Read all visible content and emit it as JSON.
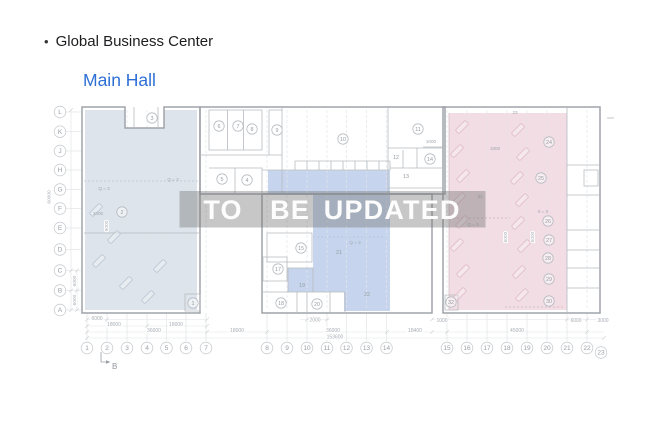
{
  "header": {
    "bullet": "•",
    "title": "Global Business Center",
    "subtitle": "Main Hall"
  },
  "watermark": {
    "text": "TO  BE UPDATED"
  },
  "colors": {
    "title": "#1d1d1f",
    "subtitle": "#2e6fd6",
    "left_zone": "#dde4eb",
    "middle_zone": "#c6d5ed",
    "right_zone": "#f1dde3",
    "band": "rgba(115,115,115,0.40)",
    "watermark_text": "#ffffff"
  },
  "axes": {
    "rows": [
      {
        "label": "L",
        "y": 112
      },
      {
        "label": "K",
        "y": 131.7
      },
      {
        "label": "J",
        "y": 151
      },
      {
        "label": "H",
        "y": 170
      },
      {
        "label": "G",
        "y": 189.5
      },
      {
        "label": "F",
        "y": 208.5
      },
      {
        "label": "E",
        "y": 228
      },
      {
        "label": "D",
        "y": 249.5
      },
      {
        "label": "C",
        "y": 270.5
      },
      {
        "label": "B",
        "y": 290.5
      },
      {
        "label": "A",
        "y": 310
      }
    ],
    "cols": [
      {
        "label": "1",
        "x": 87
      },
      {
        "label": "2",
        "x": 107
      },
      {
        "label": "3",
        "x": 127
      },
      {
        "label": "4",
        "x": 147
      },
      {
        "label": "5",
        "x": 166.5
      },
      {
        "label": "6",
        "x": 186
      },
      {
        "label": "7",
        "x": 206
      },
      {
        "label": "8",
        "x": 267
      },
      {
        "label": "9",
        "x": 287
      },
      {
        "label": "10",
        "x": 307
      },
      {
        "label": "11",
        "x": 327
      },
      {
        "label": "12",
        "x": 346.5
      },
      {
        "label": "13",
        "x": 366.5
      },
      {
        "label": "14",
        "x": 386.5
      },
      {
        "label": "15",
        "x": 447
      },
      {
        "label": "16",
        "x": 467
      },
      {
        "label": "17",
        "x": 487
      },
      {
        "label": "18",
        "x": 507
      },
      {
        "label": "19",
        "x": 527
      },
      {
        "label": "20",
        "x": 547
      },
      {
        "label": "21",
        "x": 567
      },
      {
        "label": "22",
        "x": 587
      },
      {
        "label": "23",
        "x": 601,
        "dy": 4.5
      }
    ]
  },
  "rooms": [
    {
      "n": "1",
      "x": 193,
      "y": 303,
      "circled": true
    },
    {
      "n": "2",
      "x": 122,
      "y": 212,
      "circled": true
    },
    {
      "n": "3",
      "x": 152,
      "y": 118,
      "circled": true
    },
    {
      "n": "4",
      "x": 247,
      "y": 180,
      "circled": true
    },
    {
      "n": "5",
      "x": 222,
      "y": 179,
      "circled": true
    },
    {
      "n": "6",
      "x": 219,
      "y": 126,
      "circled": true
    },
    {
      "n": "7",
      "x": 238,
      "y": 126,
      "circled": true
    },
    {
      "n": "8",
      "x": 252,
      "y": 129,
      "circled": true
    },
    {
      "n": "9",
      "x": 277,
      "y": 130,
      "circled": true
    },
    {
      "n": "10",
      "x": 343,
      "y": 139,
      "circled": true
    },
    {
      "n": "11",
      "x": 418,
      "y": 129,
      "circled": true
    },
    {
      "n": "12",
      "x": 396,
      "y": 157,
      "circled": false
    },
    {
      "n": "13",
      "x": 406,
      "y": 176,
      "circled": false
    },
    {
      "n": "14",
      "x": 430,
      "y": 159,
      "circled": true
    },
    {
      "n": "15",
      "x": 301,
      "y": 248,
      "circled": true
    },
    {
      "n": "17",
      "x": 278,
      "y": 269,
      "circled": true
    },
    {
      "n": "18",
      "x": 281,
      "y": 303,
      "circled": true
    },
    {
      "n": "19",
      "x": 302,
      "y": 285,
      "circled": false
    },
    {
      "n": "20",
      "x": 317,
      "y": 304,
      "circled": true
    },
    {
      "n": "21",
      "x": 339,
      "y": 252,
      "circled": false
    },
    {
      "n": "22",
      "x": 367,
      "y": 294,
      "circled": false
    },
    {
      "n": "24",
      "x": 549,
      "y": 142,
      "circled": true
    },
    {
      "n": "25",
      "x": 541,
      "y": 178,
      "circled": true
    },
    {
      "n": "26",
      "x": 548,
      "y": 221,
      "circled": true
    },
    {
      "n": "27",
      "x": 549,
      "y": 240,
      "circled": true
    },
    {
      "n": "28",
      "x": 548,
      "y": 258,
      "circled": true
    },
    {
      "n": "29",
      "x": 549,
      "y": 279,
      "circled": true
    },
    {
      "n": "30",
      "x": 549,
      "y": 301,
      "circled": true
    },
    {
      "n": "32",
      "x": 451,
      "y": 302,
      "circled": true
    }
  ],
  "dimensions": {
    "bottom": [
      {
        "t": "6000",
        "x": 97,
        "y": 318.5
      },
      {
        "t": "2000",
        "x": 315,
        "y": 320
      },
      {
        "t": "1000",
        "x": 442,
        "y": 320.5
      },
      {
        "t": "6000",
        "x": 576,
        "y": 320.5
      },
      {
        "t": "3000",
        "x": 603,
        "y": 320.5
      },
      {
        "t": "18000",
        "x": 114,
        "y": 324.5
      },
      {
        "t": "18000",
        "x": 176,
        "y": 324.5
      },
      {
        "t": "36000",
        "x": 154,
        "y": 330.5
      },
      {
        "t": "18000",
        "x": 237,
        "y": 330.5
      },
      {
        "t": "36000",
        "x": 333,
        "y": 330.5
      },
      {
        "t": "18400",
        "x": 415,
        "y": 330.5
      },
      {
        "t": "45000",
        "x": 517,
        "y": 330.5
      },
      {
        "t": "153600",
        "x": 335,
        "y": 337
      }
    ],
    "rotated": [
      {
        "t": "60000",
        "x": 50.5,
        "y": 197
      },
      {
        "t": "6000",
        "x": 76,
        "y": 281
      },
      {
        "t": "6000",
        "x": 76,
        "y": 300
      },
      {
        "t": "9000",
        "x": 108,
        "y": 226
      },
      {
        "t": "6000",
        "x": 507,
        "y": 237
      },
      {
        "t": "6000",
        "x": 534,
        "y": 237
      }
    ]
  },
  "annotations": [
    {
      "t": "Q = 3",
      "x": 173,
      "y": 181
    },
    {
      "t": "Q = 3",
      "x": 104,
      "y": 190
    },
    {
      "t": "Q = 3",
      "x": 355,
      "y": 244
    },
    {
      "t": "Q = 3",
      "x": 473,
      "y": 226
    },
    {
      "t": "0 = 3",
      "x": 543,
      "y": 213
    },
    {
      "t": "2000",
      "x": 98,
      "y": 215
    },
    {
      "t": "1000",
      "x": 431,
      "y": 143
    },
    {
      "t": "1800",
      "x": 495,
      "y": 150
    },
    {
      "t": "23",
      "x": 515,
      "y": 114
    },
    {
      "t": "31",
      "x": 480,
      "y": 198
    }
  ],
  "section_marker": {
    "label": "B"
  }
}
